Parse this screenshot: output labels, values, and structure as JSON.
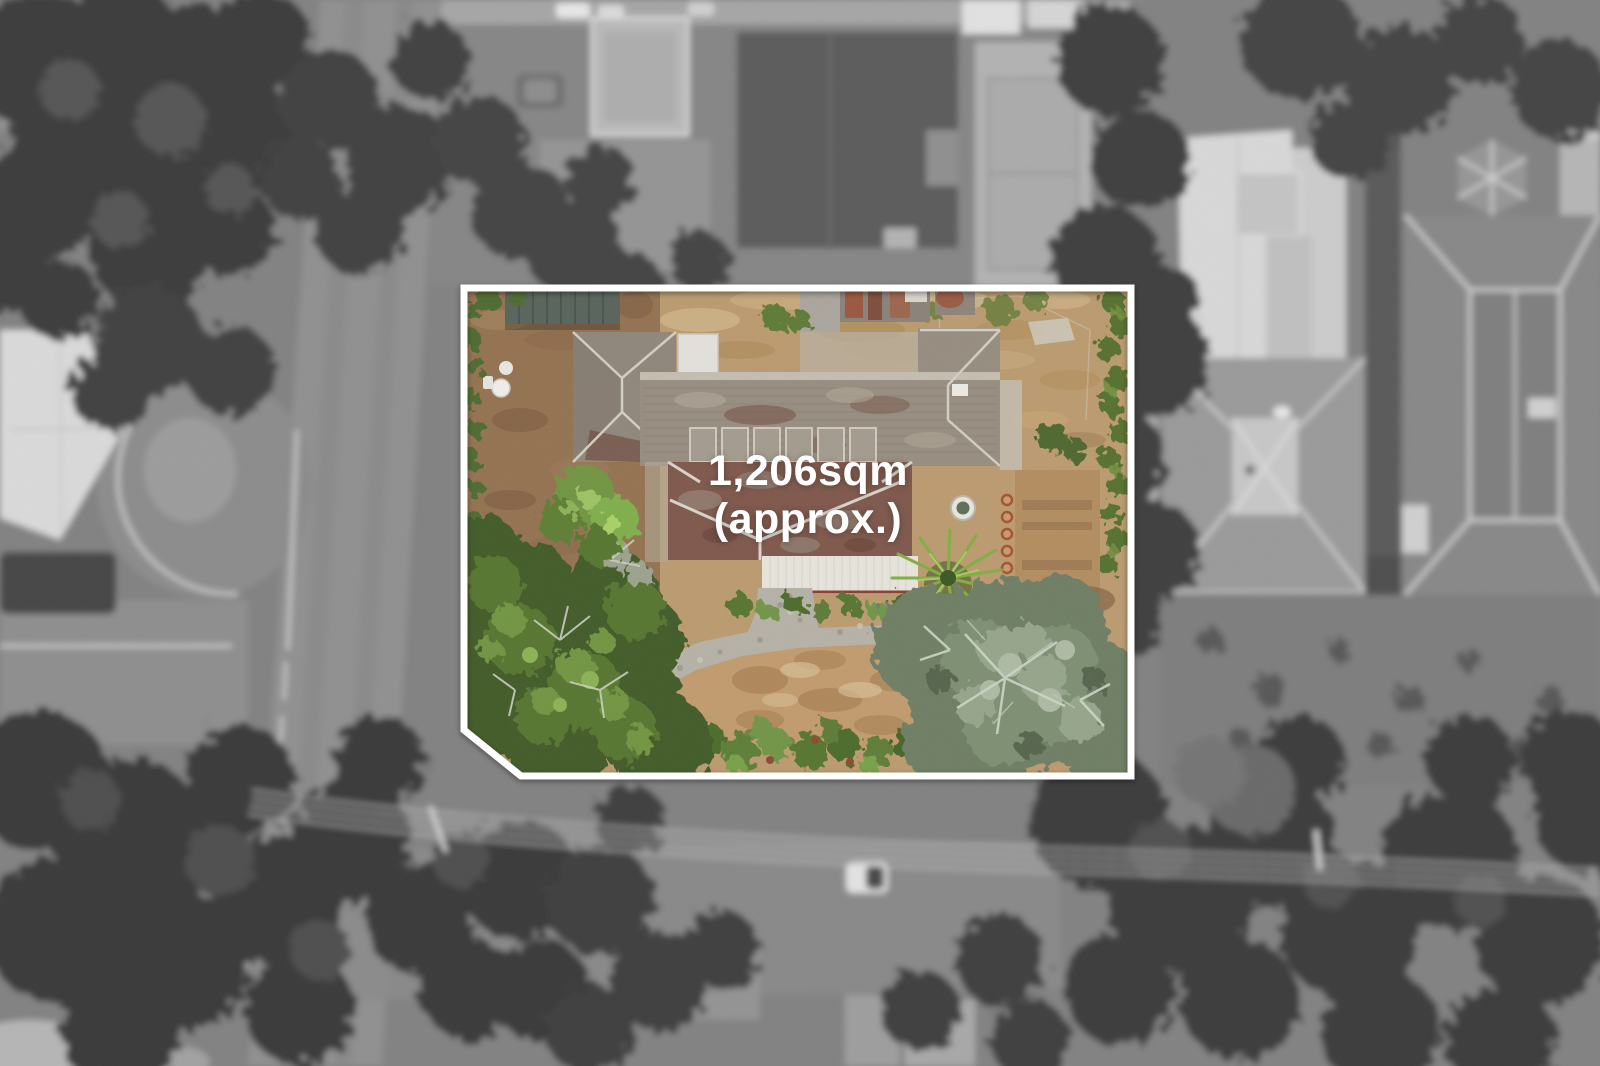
{
  "overlay": {
    "area_line1": "1,206sqm",
    "area_line2": "(approx.)"
  },
  "colors": {
    "boundary": "#ffffff",
    "overlay_text": "#ffffff"
  }
}
